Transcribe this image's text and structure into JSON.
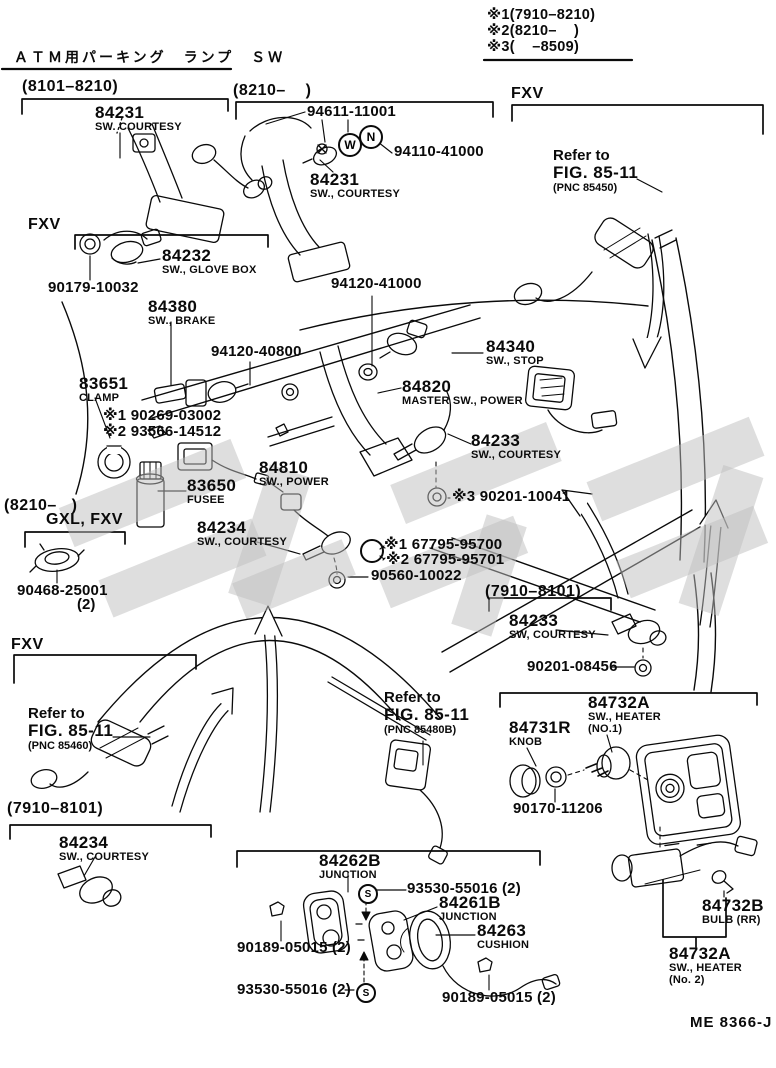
{
  "doc": {
    "title_jp": "ＡＴＭ用パーキング　ランプ　ＳＷ",
    "code": "ME 8366-J"
  },
  "notes": {
    "n1": "※1(7910–8210)",
    "n2": "※2(8210–    )",
    "n3": "※3(    –8509)"
  },
  "sections": {
    "top_left": "(8101–8210)",
    "top_mid": "(8210–    )",
    "fxv_top": "FXV",
    "fxv_mid": "FXV",
    "mid_left_range": "(8210–   )",
    "mid_left_models": "GXL, FXV",
    "right_range": "(7910–8101)",
    "fxv_bottom": "FXV",
    "bottom_left_range": "(7910–8101)"
  },
  "refs": {
    "fig_top": {
      "l1": "Refer to",
      "l2": "FIG. 85-11",
      "l3": "(PNC 85450)"
    },
    "fig_left": {
      "l1": "Refer to",
      "l2": "FIG. 85-11",
      "l3": "(PNC 85460)"
    },
    "fig_mid": {
      "l1": "Refer to",
      "l2": "FIG. 85-11",
      "l3": "(PNC 85480B)"
    }
  },
  "parts": {
    "courtesy_8101": {
      "num": "84231",
      "name": "SW. COURTESY"
    },
    "courtesy_8210": {
      "num": "84231",
      "name": "SW., COURTESY"
    },
    "glovebox": {
      "num": "84232",
      "name": "SW., GLOVE BOX"
    },
    "brake": {
      "num": "84380",
      "name": "SW., BRAKE"
    },
    "stop": {
      "num": "84340",
      "name": "SW., STOP"
    },
    "master_power": {
      "num": "84820",
      "name": "MASTER SW., POWER"
    },
    "clamp": {
      "num": "83651",
      "name": "CLAMP"
    },
    "courtesy_mid": {
      "num": "84233",
      "name": "SW., COURTESY"
    },
    "fusee": {
      "num": "83650",
      "name": "FUSEE"
    },
    "power": {
      "num": "84810",
      "name": "SW., POWER"
    },
    "courtesy_gxl": {
      "num": "84234",
      "name": "SW., COURTESY"
    },
    "courtesy_7910r": {
      "num": "84233",
      "name": "SW, COURTESY"
    },
    "courtesy_7910l": {
      "num": "84234",
      "name": "SW., COURTESY"
    },
    "knob": {
      "num": "84731R",
      "name": "KNOB"
    },
    "heater1": {
      "num": "84732A",
      "name": "SW., HEATER",
      "name2": "(NO.1)"
    },
    "junction_b": {
      "num": "84262B",
      "name": "JUNCTION"
    },
    "junction": {
      "num": "84261B",
      "name": "JUNCTION"
    },
    "cushion": {
      "num": "84263",
      "name": "CUSHION"
    },
    "bulb_rr": {
      "num": "84732B",
      "name": "BULB (RR)"
    },
    "heater2": {
      "num": "84732A",
      "name": "SW., HEATER",
      "name2": "(No. 2)"
    }
  },
  "fasteners": {
    "f94611": "94611-11001",
    "f94110": "94110-41000",
    "f90179": "90179-10032",
    "f94120a": "94120-41000",
    "f94120b": "94120-40800",
    "f90269": "※1 90269-03002",
    "f93566": "※2 93566-14512",
    "f90201a": "※3 90201-10041",
    "f67795a": "※1 67795-95700",
    "f67795b": "※2 67795-95701",
    "f90560": "90560-10022",
    "f90468": "90468-25001",
    "f90468_qty": "(2)",
    "f90201b": "90201-08456",
    "f90170": "90170-11206",
    "f93530a": "93530-55016 (2)",
    "f93530b": "93530-55016 (2)",
    "f90189a": "90189-05015 (2)",
    "f90189b": "90189-05015 (2)"
  },
  "symbols": {
    "washer": "W",
    "nut": "N",
    "screw1": "S",
    "screw2": "S"
  },
  "colors": {
    "ink": "#0a0a0a",
    "watermark": "#bdbdbd"
  }
}
